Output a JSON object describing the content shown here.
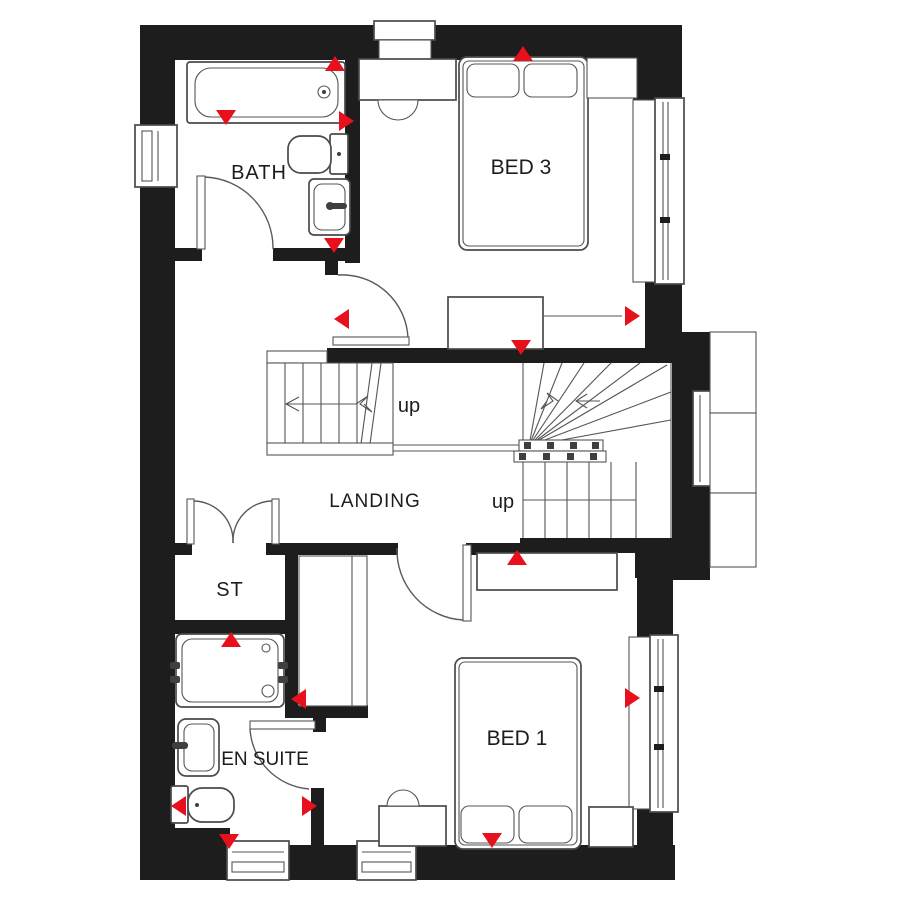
{
  "labels": {
    "bath": "BATH",
    "bed3": "BED 3",
    "landing": "LANDING",
    "st": "ST",
    "en_suite": "EN SUITE",
    "bed1": "BED 1",
    "up_left": "up",
    "up_right": "up"
  },
  "colors": {
    "wall": "#1d1d1d",
    "marker": "#e8101c",
    "line": "#4a4a4a",
    "background": "#ffffff"
  },
  "markers": [
    {
      "x": 335,
      "y": 64,
      "dir": "up"
    },
    {
      "x": 226,
      "y": 117,
      "dir": "down"
    },
    {
      "x": 346,
      "y": 121,
      "dir": "right"
    },
    {
      "x": 334,
      "y": 245,
      "dir": "down"
    },
    {
      "x": 523,
      "y": 54,
      "dir": "up"
    },
    {
      "x": 342,
      "y": 319,
      "dir": "left"
    },
    {
      "x": 521,
      "y": 347,
      "dir": "down"
    },
    {
      "x": 632,
      "y": 316,
      "dir": "right"
    },
    {
      "x": 517,
      "y": 558,
      "dir": "up"
    },
    {
      "x": 231,
      "y": 640,
      "dir": "up"
    },
    {
      "x": 299,
      "y": 699,
      "dir": "left"
    },
    {
      "x": 632,
      "y": 698,
      "dir": "right"
    },
    {
      "x": 179,
      "y": 806,
      "dir": "left"
    },
    {
      "x": 309,
      "y": 806,
      "dir": "right"
    },
    {
      "x": 229,
      "y": 841,
      "dir": "down"
    },
    {
      "x": 492,
      "y": 840,
      "dir": "down"
    }
  ]
}
